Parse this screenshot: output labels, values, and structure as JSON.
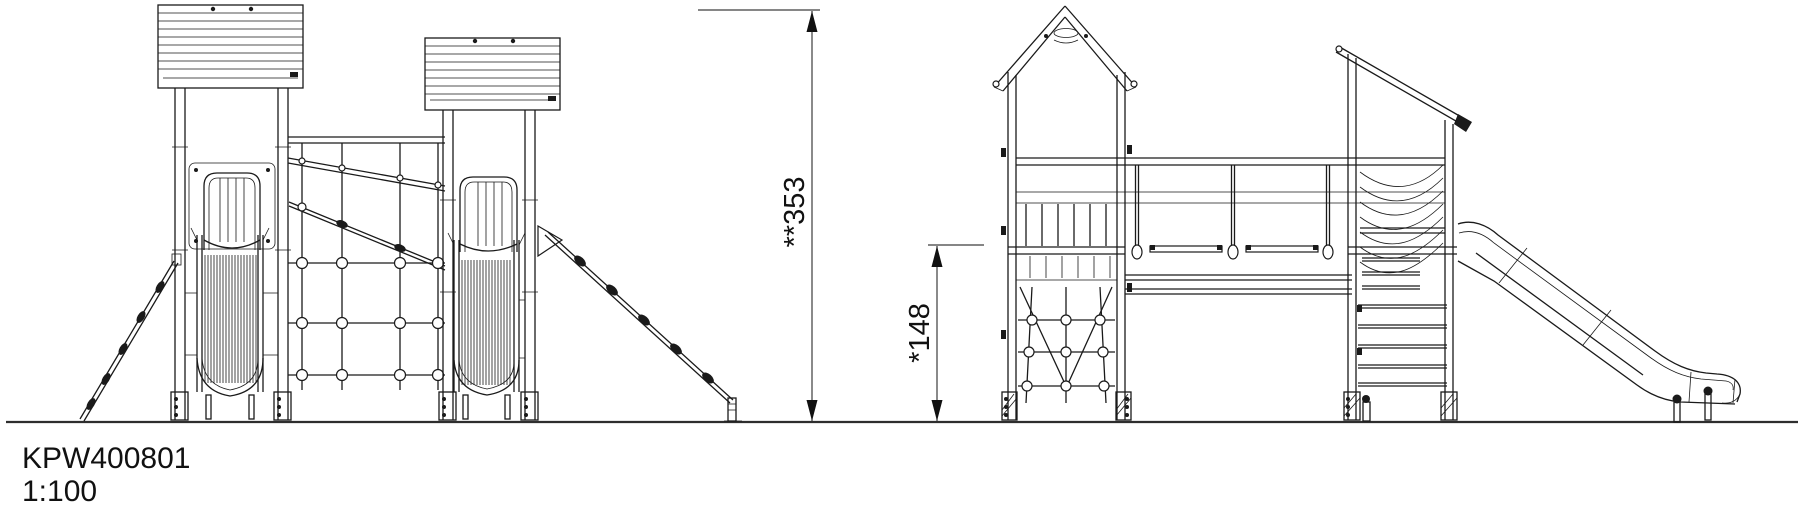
{
  "drawing": {
    "product_code": "KPW400801",
    "scale": "1:100"
  },
  "dimensions": {
    "total_height": {
      "label": "**353",
      "value": 353
    },
    "platform_height": {
      "label": "*148",
      "value": 148
    }
  },
  "style": {
    "ink_color": "#1a1a1a",
    "dimension_color": "#3d3d3d",
    "background_color": "#ffffff"
  }
}
